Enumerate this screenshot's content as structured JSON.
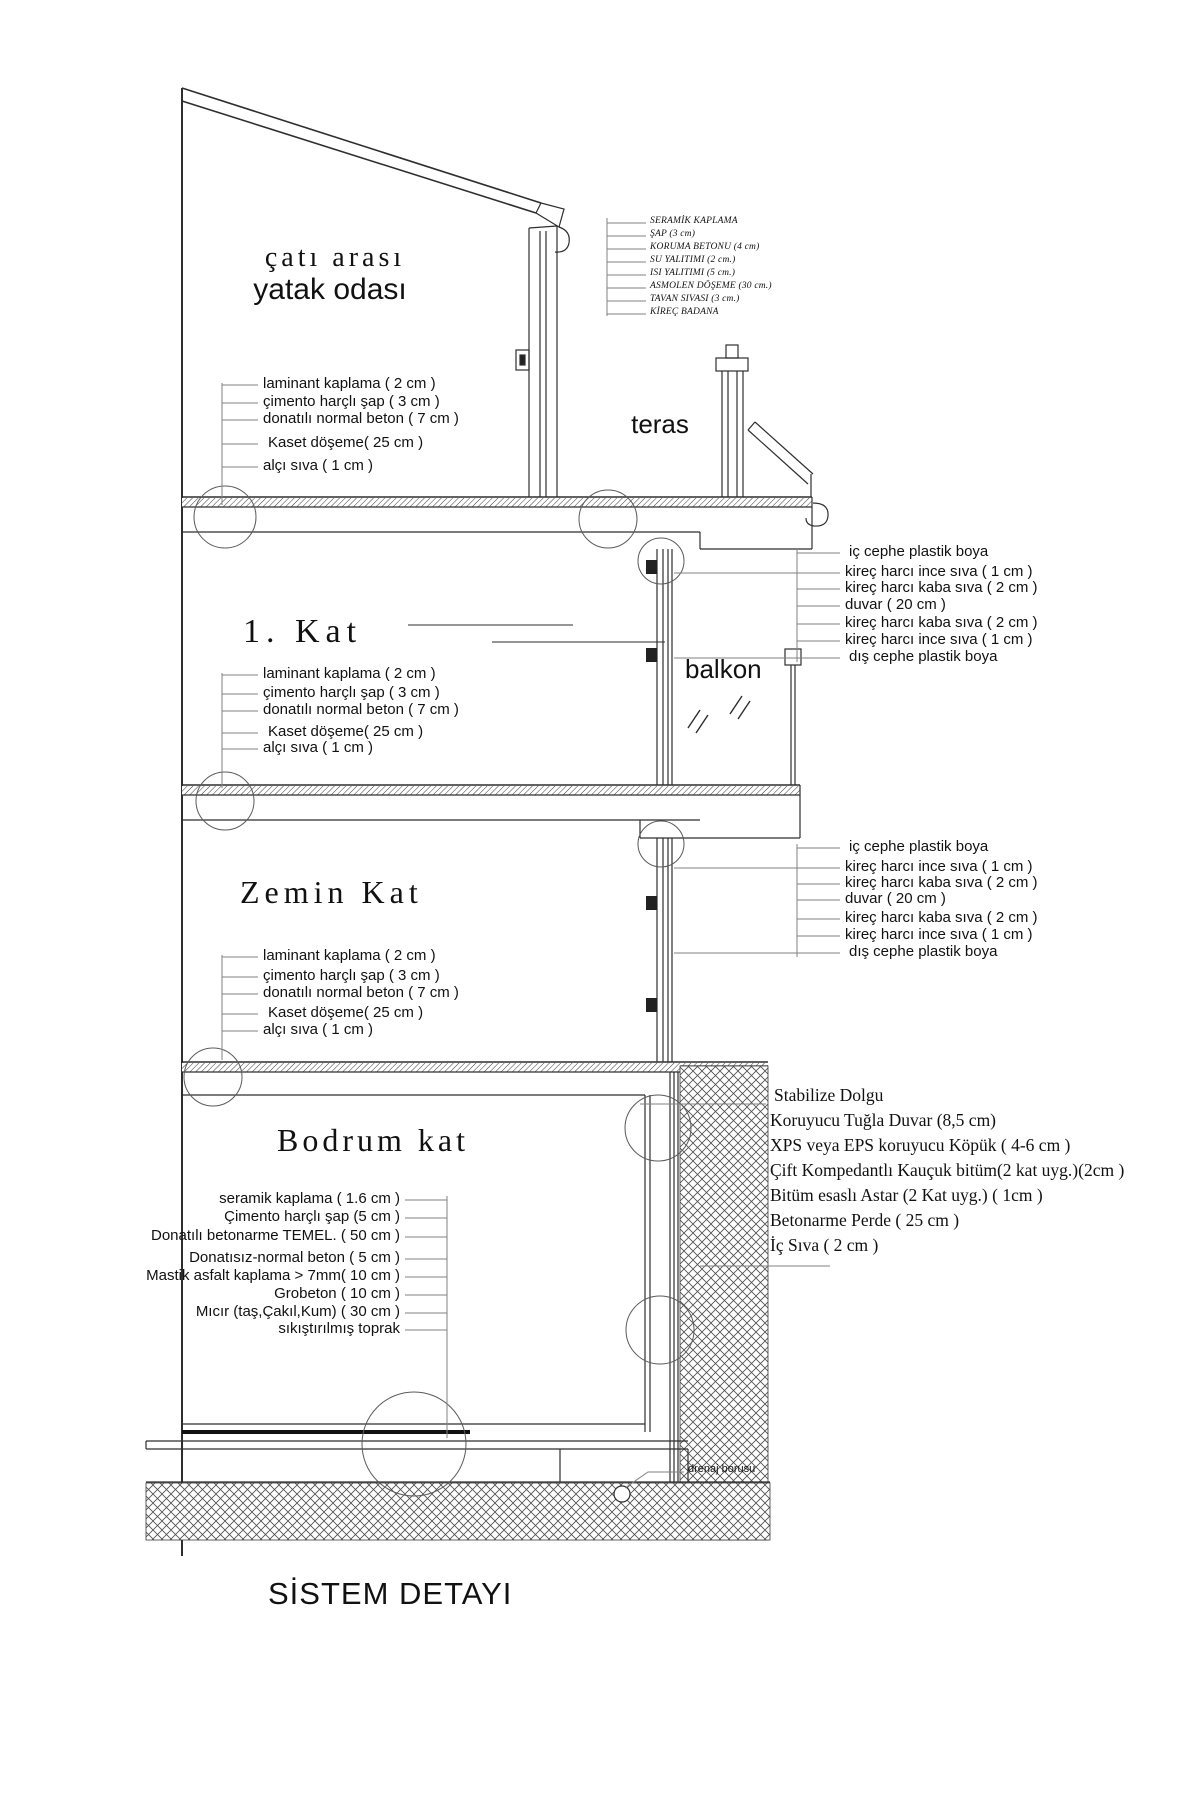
{
  "title": "SİSTEM DETAYI",
  "rooms": {
    "attic_line1": "çatı arası",
    "attic_line2": "yatak odası",
    "first_floor": "1. Kat",
    "ground_floor": "Zemin Kat",
    "basement": "Bodrum kat",
    "terrace": "teras",
    "balcony": "balkon"
  },
  "roof_stack": {
    "items": [
      "SERAMİK KAPLAMA",
      "ŞAP (3 cm)",
      "KORUMA BETONU (4 cm)",
      "SU YALITIMI (2 cm.)",
      "ISI YALITIMI (5 cm.)",
      "ASMOLEN DÖŞEME (30 cm.)",
      "TAVAN SIVASI (3 cm.)",
      "KİREÇ BADANA"
    ]
  },
  "floor_stack": {
    "items": [
      "laminant kaplama ( 2 cm )",
      "çimento harçlı şap ( 3 cm )",
      "donatılı normal beton ( 7 cm )",
      "Kaset döşeme( 25 cm )",
      "alçı sıva ( 1 cm )"
    ]
  },
  "wall_stack": {
    "items": [
      "iç cephe plastik boya",
      "kireç harcı ince sıva ( 1 cm )",
      "kireç harcı kaba sıva ( 2 cm )",
      "duvar ( 20 cm )",
      "kireç harcı kaba sıva ( 2 cm )",
      "kireç harcı ince sıva ( 1 cm )",
      "dış cephe plastik boya"
    ]
  },
  "basement_floor_stack": {
    "items": [
      "seramik kaplama ( 1.6 cm )",
      "Çimento harçlı şap (5 cm )",
      "Donatılı betonarme TEMEL. ( 50 cm )",
      "Donatısız-normal beton ( 5 cm )",
      "Mastik asfalt kaplama > 7mm( 10 cm )",
      "Grobeton ( 10 cm )",
      "Mıcır (taş,Çakıl,Kum) ( 30 cm )",
      "sıkıştırılmış toprak"
    ]
  },
  "basement_wall_stack": {
    "items": [
      "Stabilize Dolgu",
      "Koruyucu Tuğla Duvar (8,5 cm)",
      "XPS veya EPS koruyucu Köpük ( 4-6 cm )",
      "Çift Kompedantlı Kauçuk bitüm(2 kat uyg.)(2cm )",
      "Bitüm esaslı Astar (2 Kat uyg.) ( 1cm )",
      "Betonarme Perde  ( 25 cm )",
      "İç Sıva  ( 2 cm )"
    ]
  },
  "annotations": {
    "drain": "drenaj borusu"
  },
  "colors": {
    "ink": "#111111",
    "line": "#2e2e2e",
    "leader": "#828282",
    "background": "#ffffff"
  }
}
